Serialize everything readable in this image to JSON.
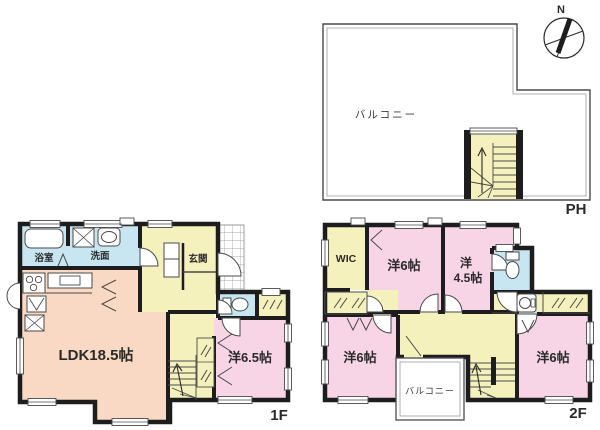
{
  "title": "間取り図",
  "colors": {
    "wall": "#1d1d1d",
    "room_pink": "#f8d5e6",
    "room_peach": "#f9d9c3",
    "room_yellow": "#f5f1bd",
    "room_blue": "#c8e6f2",
    "balcony_white": "#ffffff",
    "thin_line": "#4a4a4a",
    "grid_line": "#8a9096",
    "text": "#2a2a2a"
  },
  "compass": {
    "north": "N"
  },
  "ph": {
    "label": "PH",
    "balcony": "バルコニー"
  },
  "f1": {
    "label": "1F",
    "ldk": "LDK18.5帖",
    "western65": "洋6.5帖",
    "bath": "浴室",
    "wash": "洗面",
    "entrance": "玄関"
  },
  "f2": {
    "label": "2F",
    "wic": "WIC",
    "west_tl": "洋6帖",
    "west45_l1": "洋",
    "west45_l2": "4.5帖",
    "west_bl": "洋6帖",
    "west_br": "洋6帖",
    "balcony": "バルコニー"
  },
  "icons": {
    "compass": "compass-icon",
    "bathtub": "bathtub-icon",
    "washer": "washer-icon",
    "basin": "washbasin-icon",
    "stove": "stove-icon",
    "toilet": "toilet-icon",
    "stairs": "stairs-icon"
  }
}
